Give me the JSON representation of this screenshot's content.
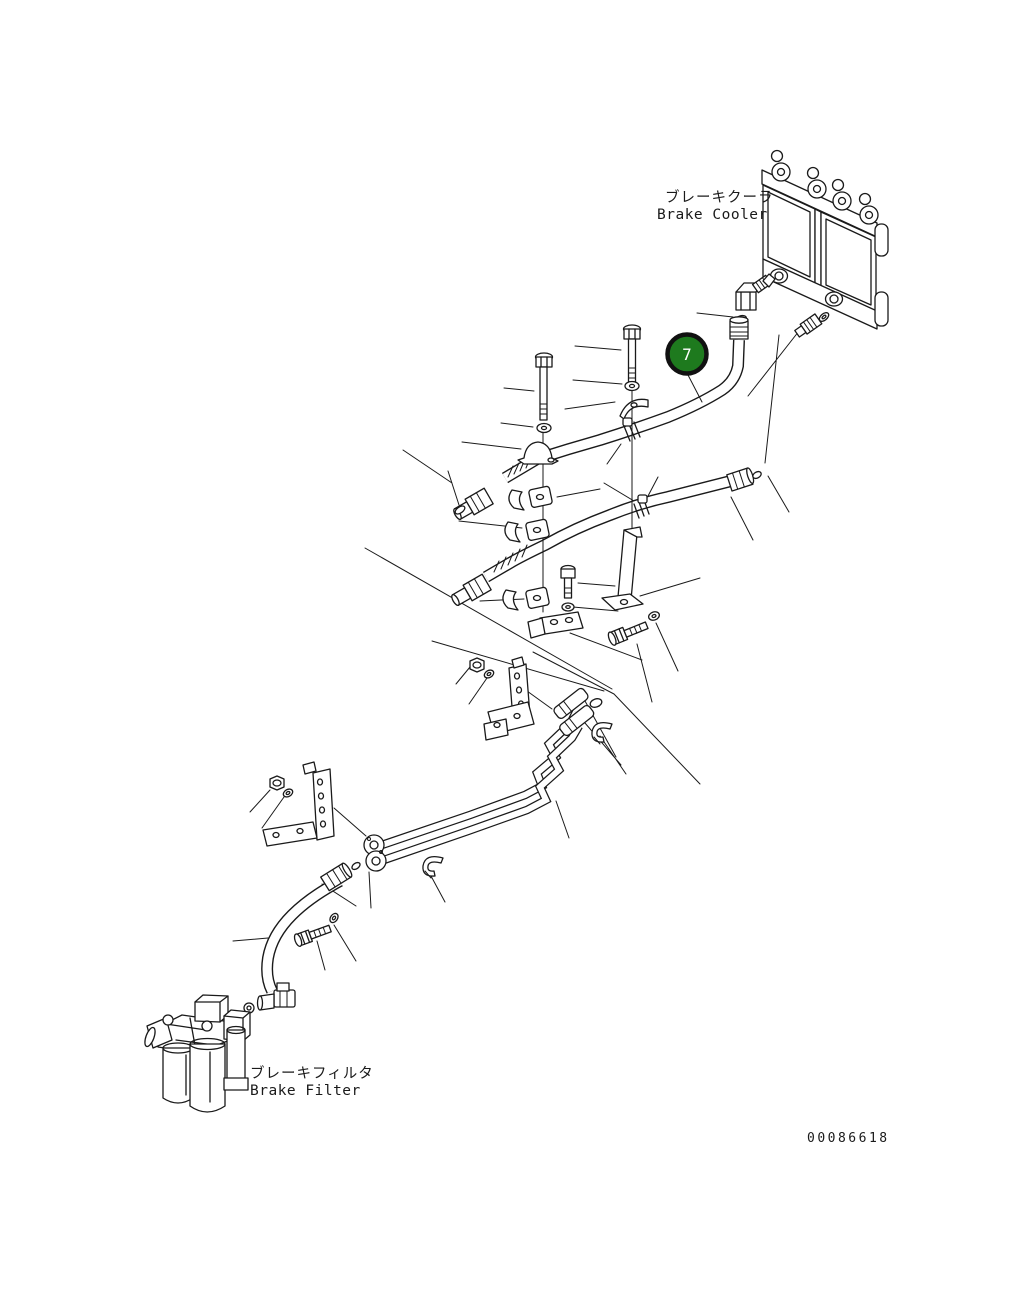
{
  "page": {
    "background_color": "#ffffff",
    "line_color": "#1a1a1a"
  },
  "labels": {
    "brake_cooler_jp": "ブレーキクーラ",
    "brake_cooler_en": "Brake Cooler",
    "brake_filter_jp": "ブレーキフィルタ",
    "brake_filter_en": "Brake Filter"
  },
  "callout": {
    "number": "7",
    "fill_color": "#1e7a1e",
    "ring_color": "#111111",
    "number_color": "#ffffff"
  },
  "drawing_number": "00086618",
  "icons": {
    "callout_balloon": "numbered-callout-balloon-icon"
  }
}
